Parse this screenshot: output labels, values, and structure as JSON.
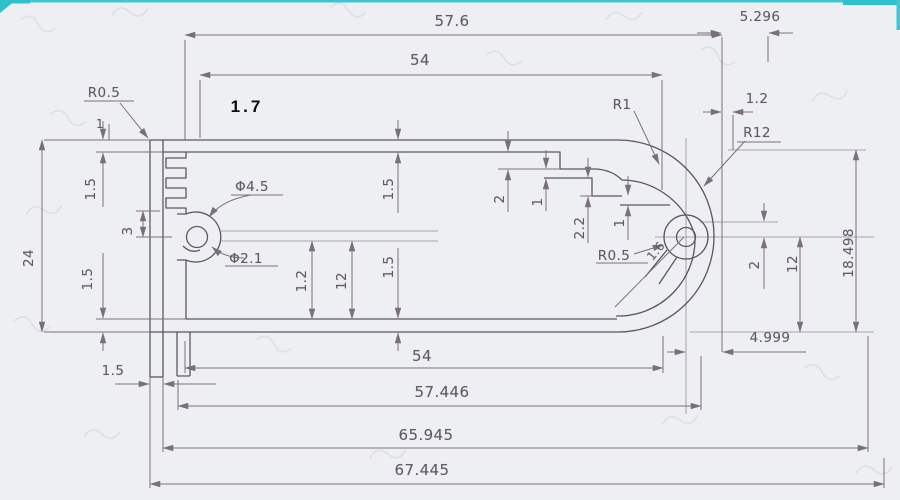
{
  "page": {
    "kind": "scanned engineering cross-section drawing",
    "paper_color": "#edeff2",
    "ink_color": "#645d69",
    "accent_color": "#35c6d1"
  },
  "labels": {
    "dim_57_6": "57.6",
    "dim_5_296": "5.296",
    "dim_54_top": "54",
    "r0_5_left": "R0.5",
    "note_1_7": "1.7",
    "dim_1_top_left": "1",
    "r1": "R1",
    "dim_1_2_top_right": "1.2",
    "r12": "R12",
    "dim_24": "24",
    "dim_1_5_left_top": "1.5",
    "dim_3": "3",
    "dim_1_5_left_bottom": "1.5",
    "dia_4_5": "Φ4.5",
    "dia_2_1": "Φ2.1",
    "dim_1_2_mid": "1.2",
    "dim_12_mid": "12",
    "dim_1_5_mid_top": "1.5",
    "dim_1_5_mid_bottom": "1.5",
    "dim_2_mid": "2",
    "dim_1_mid": "1",
    "dim_2_2": "2.2",
    "dim_1_right_step": "1",
    "r0_5_right": "R0.5",
    "dim_1_6": "1.6",
    "dim_2_right": "2",
    "dim_12_right": "12",
    "dim_18_498": "18.498",
    "dim_4_999": "4.999",
    "dim_1_5_bottom_left": "1.5",
    "dim_54_bottom": "54",
    "dim_57_446": "57.446",
    "dim_65_945": "65.945",
    "dim_67_445": "67.445"
  }
}
